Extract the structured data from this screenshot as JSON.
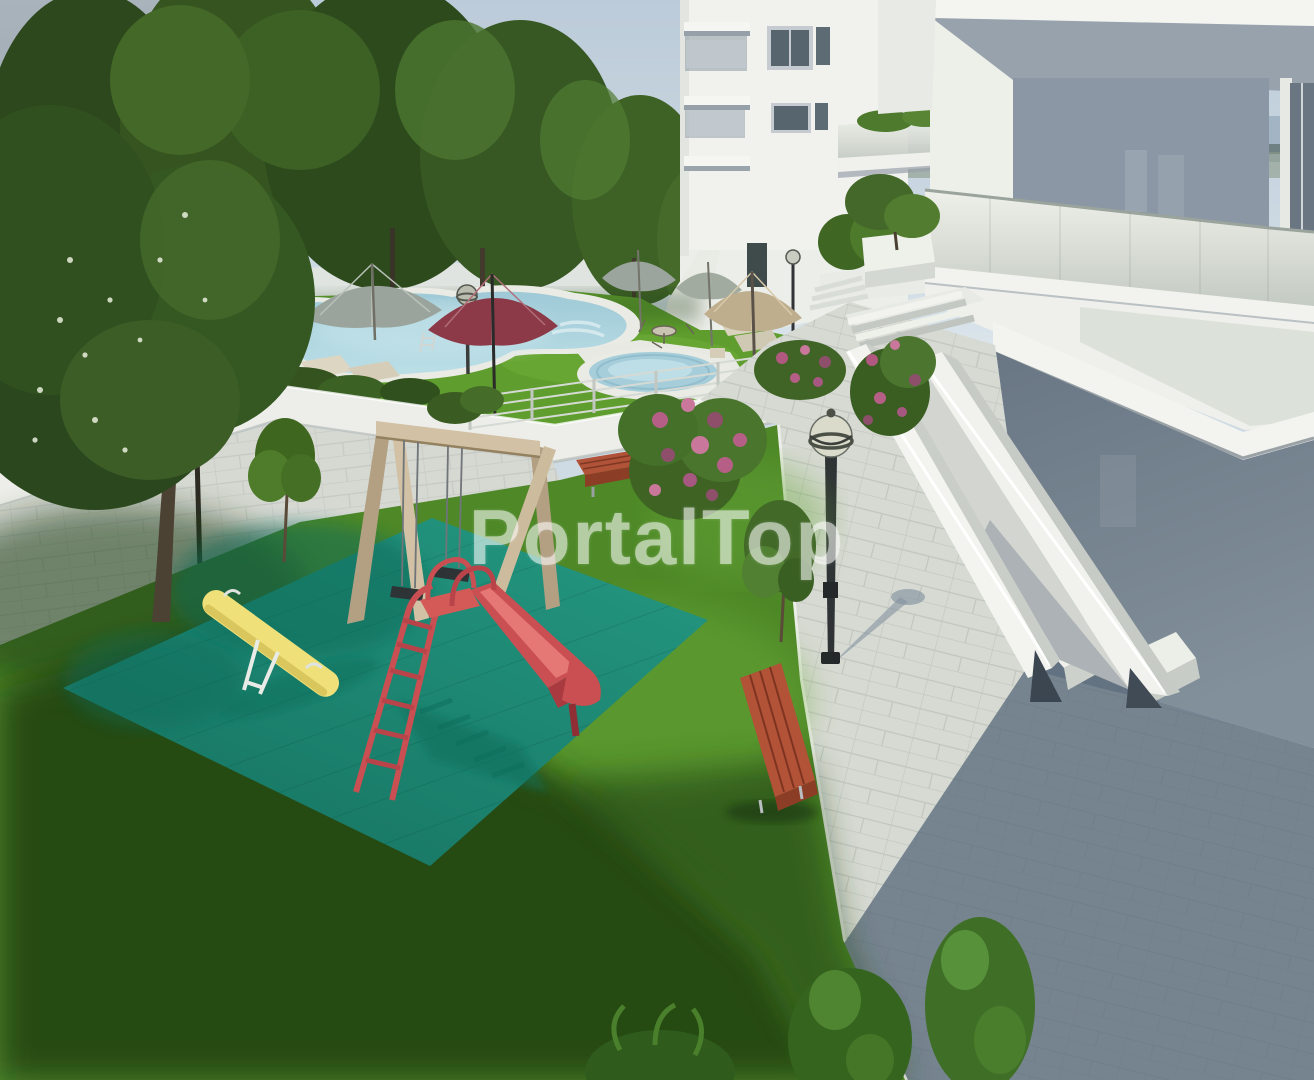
{
  "image": {
    "width": 1314,
    "height": 1080,
    "kind": "3d-architectural-render"
  },
  "watermark": {
    "text": "PortalTop",
    "color": "#ffffff"
  },
  "palette": {
    "sky": "#bccbd9",
    "sea": "#93a7b8",
    "tree_dark": "#2c481c",
    "tree_light": "#4c7630",
    "grass_sun": "#5f9e2e",
    "grass_lower": "#4e8827",
    "grass_shadow": "#1c3a10",
    "mat_teal": "#23957f",
    "pool_water": "#a5cdda",
    "deck_white": "#e9ebe4",
    "building_white": "#f1f2ee",
    "building_shadow_wall": "#73808d",
    "pavement_light": "#d7dad3",
    "pavement_shadow": "#5b6b7c",
    "slide_red": "#c94f52",
    "seesaw_yellow": "#efe07a",
    "swing_wood": "#d2c1a4",
    "bench_wood": "#b05338",
    "umbrella_gray": "#9aa49c",
    "umbrella_maroon": "#8c3a48",
    "umbrella_tan": "#bfae8e",
    "lamp_metal": "#2f3336"
  }
}
